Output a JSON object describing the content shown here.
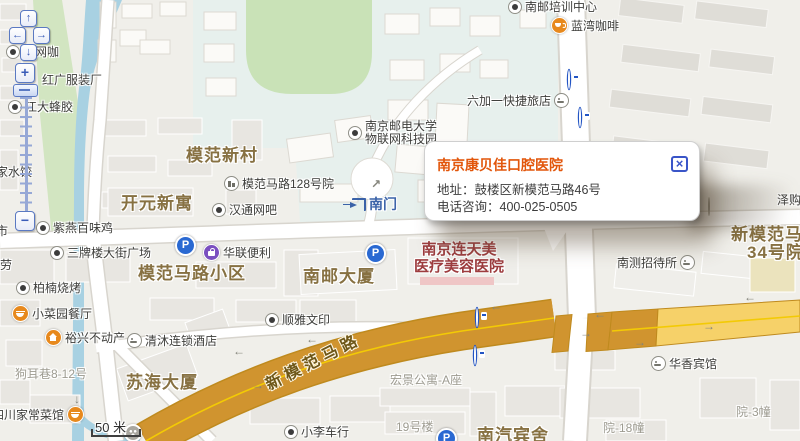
{
  "icons": {
    "parking_glyph": "P",
    "close_glyph": "×",
    "pan_up": "↑",
    "pan_left": "←",
    "pan_right": "→",
    "pan_down": "↓",
    "zoom_in": "+",
    "zoom_out": "−",
    "arrow_left": "←",
    "arrow_right": "→",
    "arrow_down": "↓",
    "arrow_up_right": "↗"
  },
  "popup": {
    "title": "南京康贝佳口腔医院",
    "address_label": "地址：",
    "address": "鼓楼区新模范马路46号",
    "phone_label": "电话咨询：",
    "phone": "400-025-0505"
  },
  "scale": {
    "distance": "50 米"
  },
  "roads": {
    "main_road": "新模范马路"
  },
  "districts": {
    "mofan_xincun": "模范新村",
    "kaiyuan_xinyu": "开元新寓",
    "mofan_malu_xiaoqu": "模范马路小区",
    "nanyou_dasha": "南邮大厦",
    "suhai_dasha": "苏海大厦",
    "nanqi_binshe": "南汽宾舍",
    "compound34_line1": "新模范马路",
    "compound34_line2": "34号院"
  },
  "clinic": {
    "line1": "南京连天美",
    "line2": "医疗美容医院"
  },
  "pois": {
    "peixun": "南邮培训中心",
    "lanwan": "蓝湾咖啡",
    "liujiayi": "六加一快捷旅店",
    "njupt_line1": "南京邮电大学",
    "njupt_line2": "物联网科技园",
    "yard128": "模范马路128号院",
    "hantong": "汉通网吧",
    "nanmen": "南门",
    "langwangka": "浪网咖",
    "hongguang": "红广服装厂",
    "jiangda": "江大蜂胶",
    "jiashuijiao": "家水饺",
    "chaoshi": "超市",
    "lao": "劳",
    "ziyan": "紫燕百味鸡",
    "sanpailou": "三牌楼大街广场",
    "hualian": "华联便利",
    "bainan": "柏楠烧烤",
    "xiaocaiyuan": "小菜园餐厅",
    "yuxing": "裕兴不动产",
    "sichuan": "四川家常菜馆",
    "shunya": "顺雅文印",
    "qingmu": "清沐连锁酒店",
    "xiaoli": "小李车行",
    "nance": "南测招待所",
    "huaxiang": "华香宾馆",
    "zegou": "泽购超市",
    "gouerxiang": "狗耳巷8-12号",
    "building19": "19号楼",
    "yard18": "院-18幢",
    "yard3": "院-3幢",
    "hongjing": "宏景公寓-A座"
  }
}
